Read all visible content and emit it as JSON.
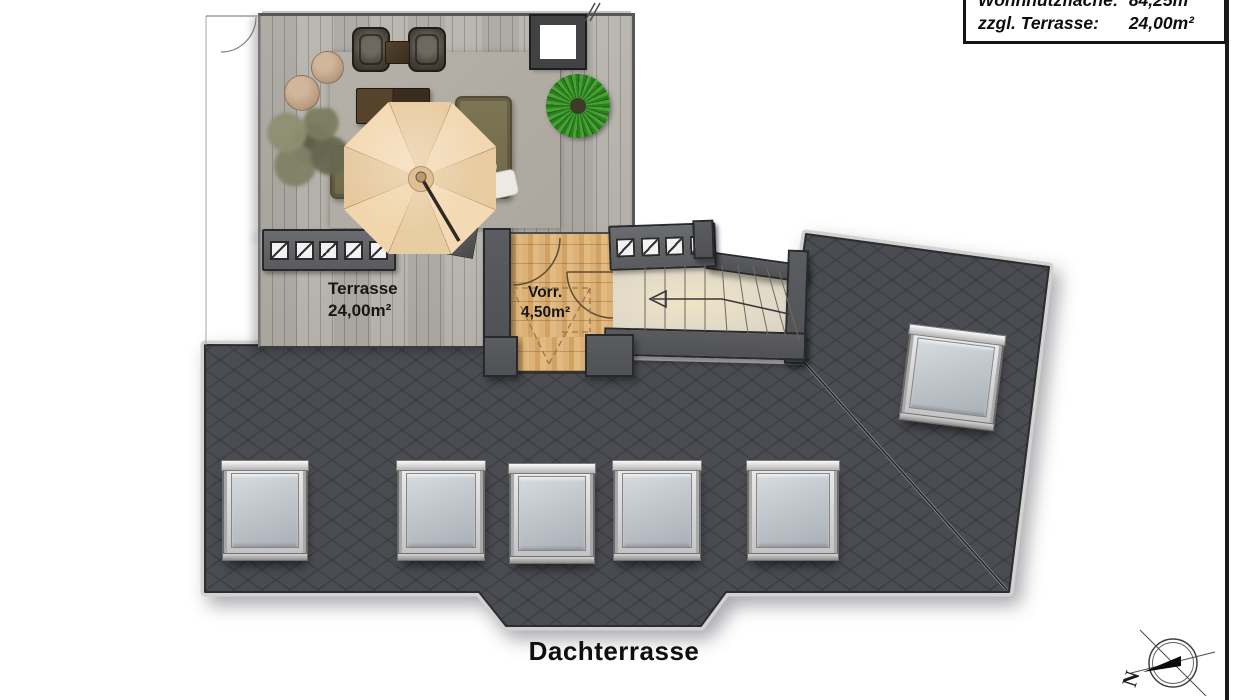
{
  "info_box": {
    "rows": [
      {
        "label": "Wohnnutzfläche:",
        "value": "84,25m²"
      },
      {
        "label": "zzgl. Terrasse:",
        "value": "24,00m²"
      }
    ]
  },
  "plan": {
    "title": "Dachterrasse",
    "rooms": [
      {
        "name": "Terrasse",
        "area": "24,00m²"
      },
      {
        "name": "Vorr.",
        "area": "4,50m²"
      }
    ],
    "compass_north": "N"
  },
  "colors": {
    "roof_slate": "#4a4c52",
    "deck_gray": "#b6b3ad",
    "wood_oak": "#d9ab72",
    "stairs_cream": "#e3dbc8",
    "parasol_cream": "#f1d6ae",
    "sofa_olive": "#7a7352",
    "plant_green": "#3f9e2f"
  }
}
